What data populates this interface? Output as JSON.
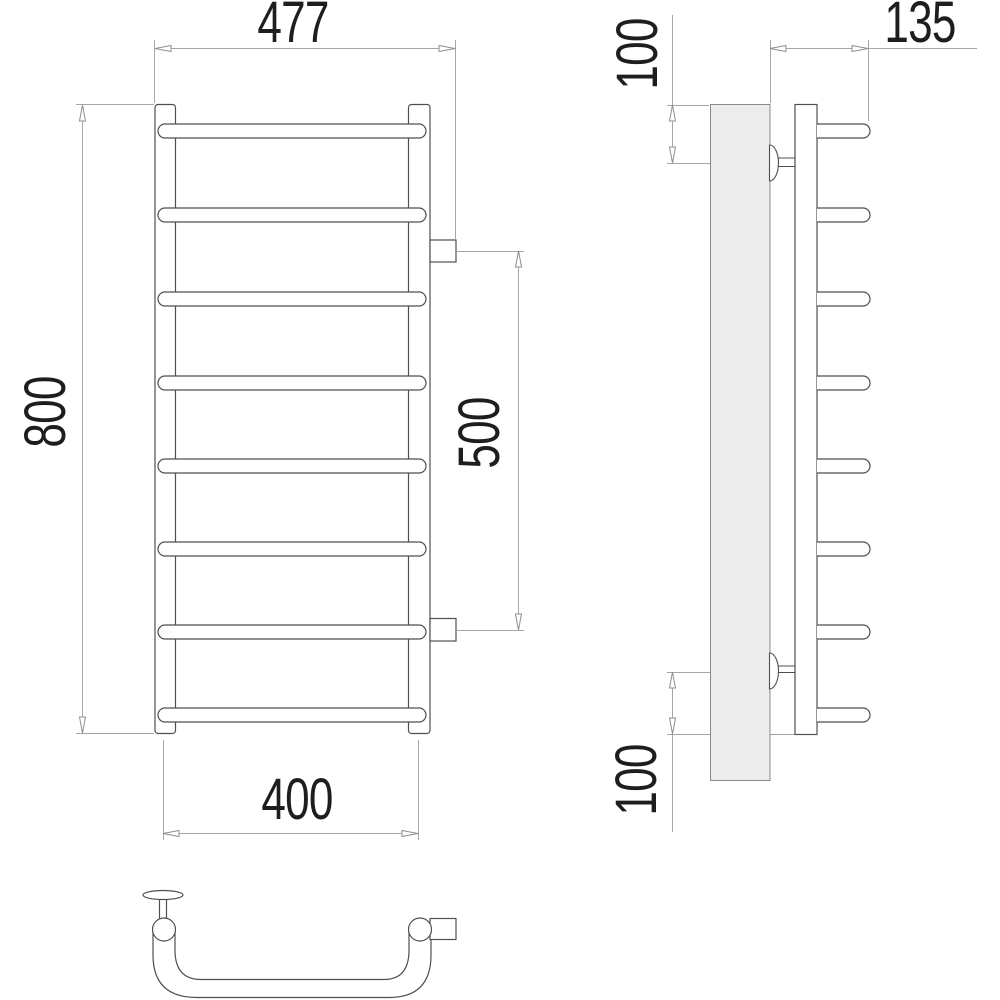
{
  "drawing": {
    "type": "technical-drawing",
    "subject": "ladder-style heated towel rail, front / side / bottom views",
    "views": {
      "front": "front view with 8 horizontal rungs",
      "side": "side view with wall panel and two mounting brackets",
      "bottom": "bottom (plan) view of curved rung with wall bracket and side connection"
    },
    "dimensions": {
      "overall_width": "477",
      "height": "800",
      "rung_center_width": "400",
      "connection_spacing": "500",
      "depth": "135",
      "top_mount_offset": "100",
      "bottom_mount_offset": "100"
    },
    "colors": {
      "outline": "#4f4f4f",
      "wall_border": "#8a8a8a",
      "wall_fill": "#ececec",
      "dimension_line": "#a6a6a6",
      "text": "#1e1e1e",
      "background": "#ffffff"
    }
  }
}
